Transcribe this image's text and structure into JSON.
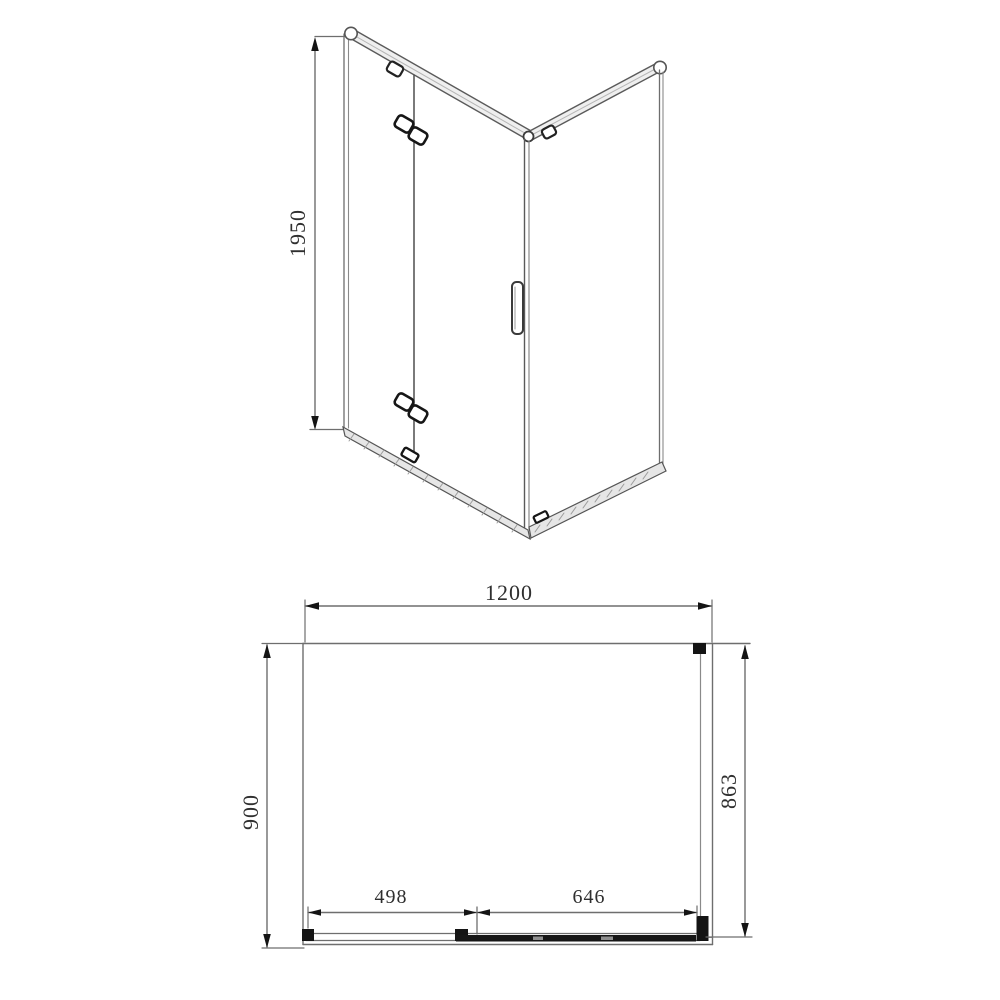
{
  "figure": {
    "background": "#ffffff",
    "line_color": "#6e6e6e",
    "accent_color": "#141414"
  },
  "elevation_view": {
    "height_dim": {
      "label": "1950"
    }
  },
  "plan_view": {
    "width_dim": {
      "label": "1200"
    },
    "depth_dim": {
      "label": "900"
    },
    "side_panel_dim": {
      "label": "863"
    },
    "fixed_panel_dim": {
      "label": "498"
    },
    "door_dim": {
      "label": "646"
    }
  }
}
